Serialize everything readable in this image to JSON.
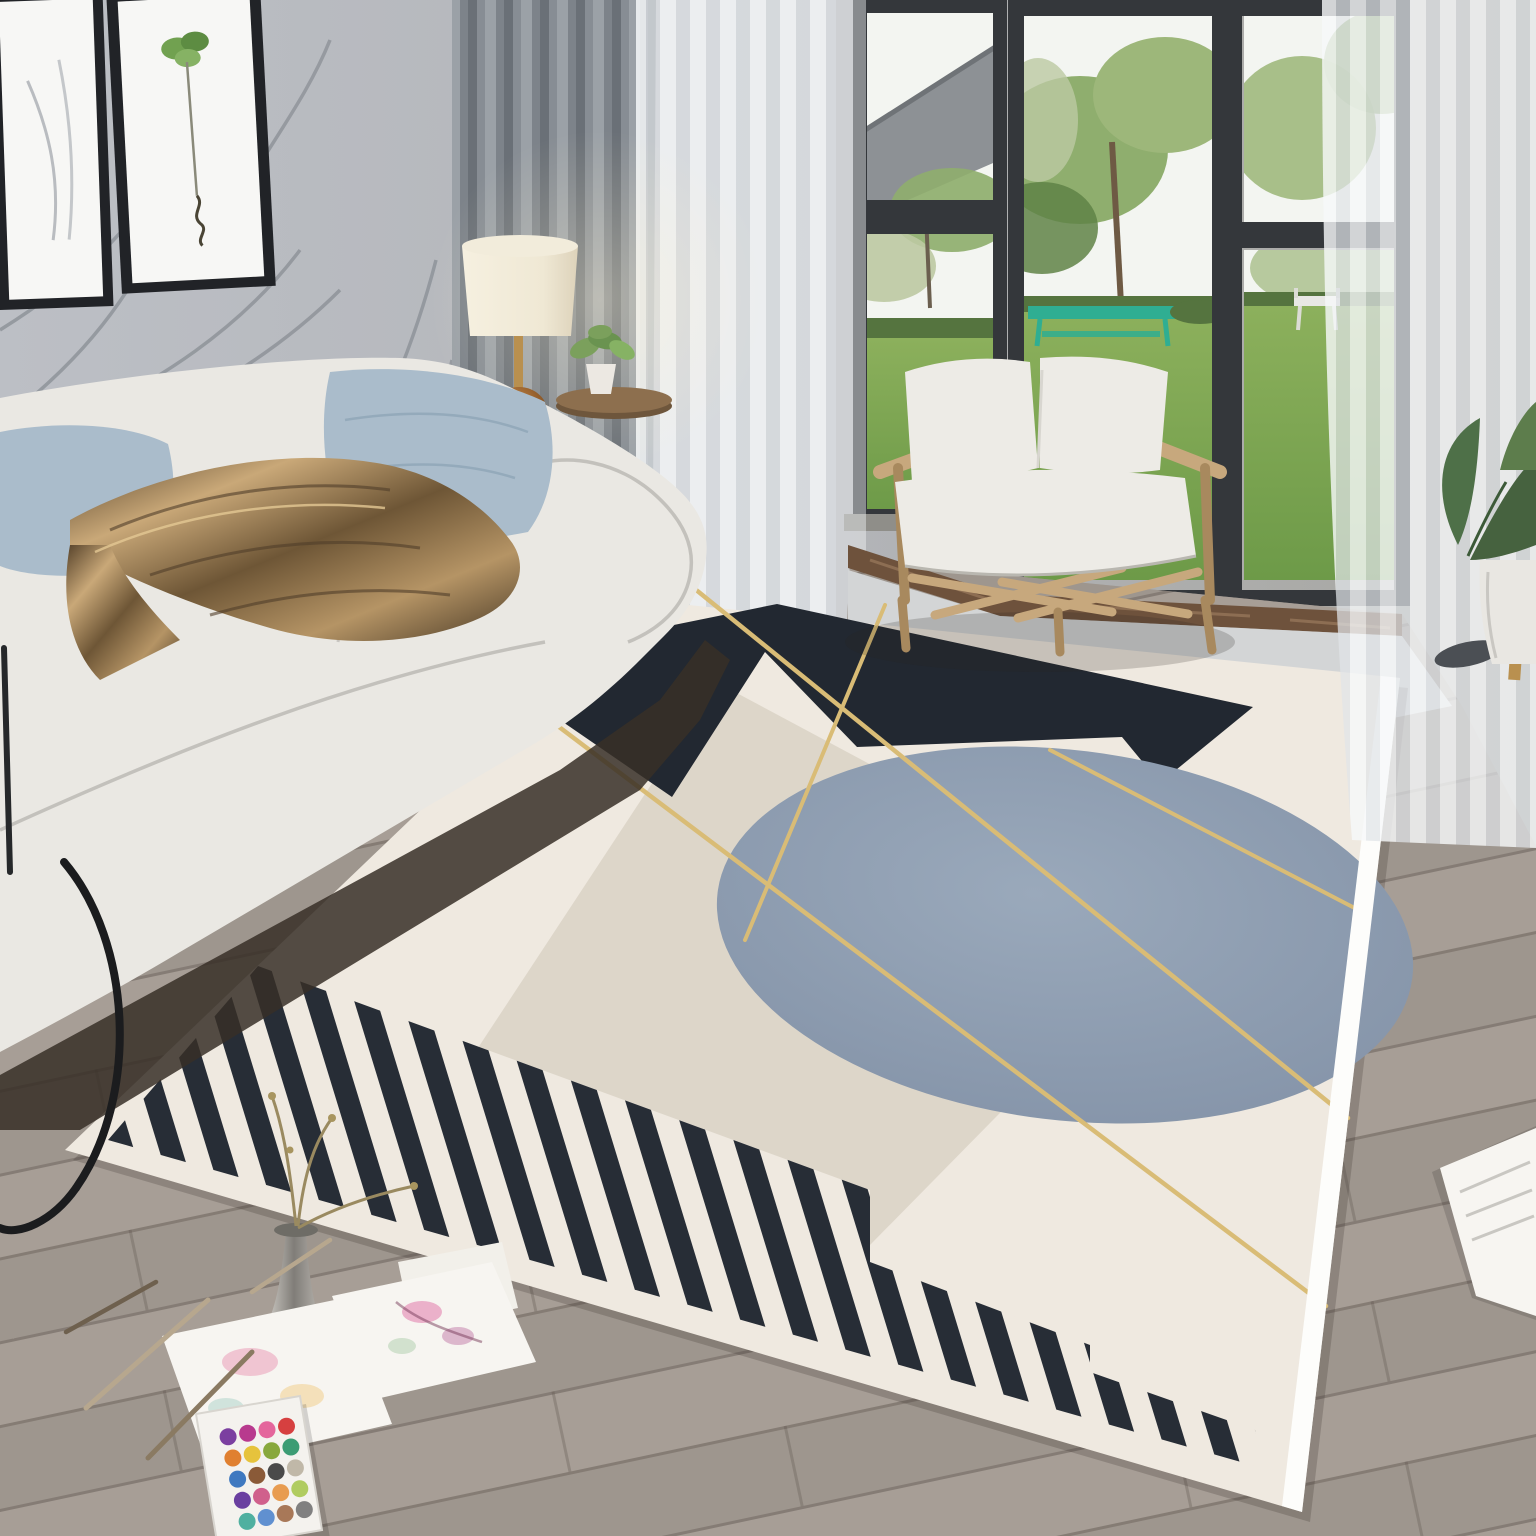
{
  "scene": {
    "title": "Living room photo with a modern geometric area rug, white sofa, rattan armchair, gray curtains and garden windows",
    "room_elements": [
      "gray wall with botanical line-art mural",
      "two black-framed botanical prints",
      "gray blackout curtain",
      "white sheer curtains",
      "black-framed windows",
      "garden view with lawn, trees and teal table",
      "marble threshold",
      "light carpet by window",
      "gray wood plank floor"
    ],
    "furniture": [
      "white fabric sofa",
      "light blue pillows",
      "bronze satin throw",
      "light-wood armchair with white cushions",
      "table lamp with cream shade",
      "round wooden side table with small plant",
      "black metal side table (partial, left edge)"
    ],
    "rug": {
      "style": "modern geometric area rug",
      "elements": [
        "ivory field",
        "black angular shape",
        "taupe rotated square",
        "speckled blue-gray circle",
        "thin gold diagonal lines",
        "black stripe band with stepped stripes",
        "white edge band"
      ]
    },
    "floor_items": [
      "two watercolor paintings",
      "watercolor paint palette",
      "paint brushes",
      "metal vase with dried branches",
      "white book (bottom right)",
      "dark slipper",
      "potted plant (bottom right)"
    ]
  },
  "palette": {
    "wall": "#b9bcc2",
    "wall-shade": "#a8a7a1",
    "mural": "#8f949a",
    "frame": "#212327",
    "mat": "#f7f7f5",
    "art-green": "#71a150",
    "curtain": "#858b92",
    "sheer": "#eef0f2",
    "window-frame": "#34373b",
    "sky": "#f3f5f1",
    "foliage": "#8fae6e",
    "foliage-dark": "#5f8247",
    "foliage-pale": "#bcc9a2",
    "lawn": "#7da64f",
    "hedge": "#55743f",
    "teal": "#2fae92",
    "roof": "#8d9195",
    "marble": "#6e523c",
    "carpet": "#d3d5d6",
    "floor": "#a69d95",
    "sofa": "#eae8e3",
    "sofa-line": "#b9b7b2",
    "under-shadow": "#372f27",
    "pillow": "#aabccb",
    "pillow-dark": "#8fa5b6",
    "throw-light": "#c9a878",
    "throw-dark": "#503e29",
    "wood": "#c7a87d",
    "wood-dark": "#a8895e",
    "cushion": "#edebe6",
    "lamp-shade": "#f2ecdb",
    "gold": "#b9904f",
    "glass": "#8a5a2f",
    "table-wood": "#8d6f4e",
    "rug-cream": "#efe9e0",
    "rug-beige": "#ddd6c9",
    "rug-black": "#222831",
    "rug-circle": "#8e9db1",
    "rug-gold": "#d9bc76",
    "rug-white": "#fdfdfb",
    "stripe": "#272d36",
    "paper": "#f7f5f1",
    "metal": "#8e8c86",
    "leaf": "#46623f"
  },
  "palette_tray": {
    "cols": 4,
    "rows": 5,
    "colors": [
      "#7b3fa0",
      "#b83a8e",
      "#e4669c",
      "#d64040",
      "#e08030",
      "#e6c33c",
      "#88a83c",
      "#3c9c74",
      "#3f79c0",
      "#8a5a38",
      "#4a4a4a",
      "#c0b8a8",
      "#6a3fa0",
      "#d0608c",
      "#e89c50",
      "#b0cc60",
      "#50b0a0",
      "#6090d0",
      "#a87858",
      "#808080"
    ]
  }
}
